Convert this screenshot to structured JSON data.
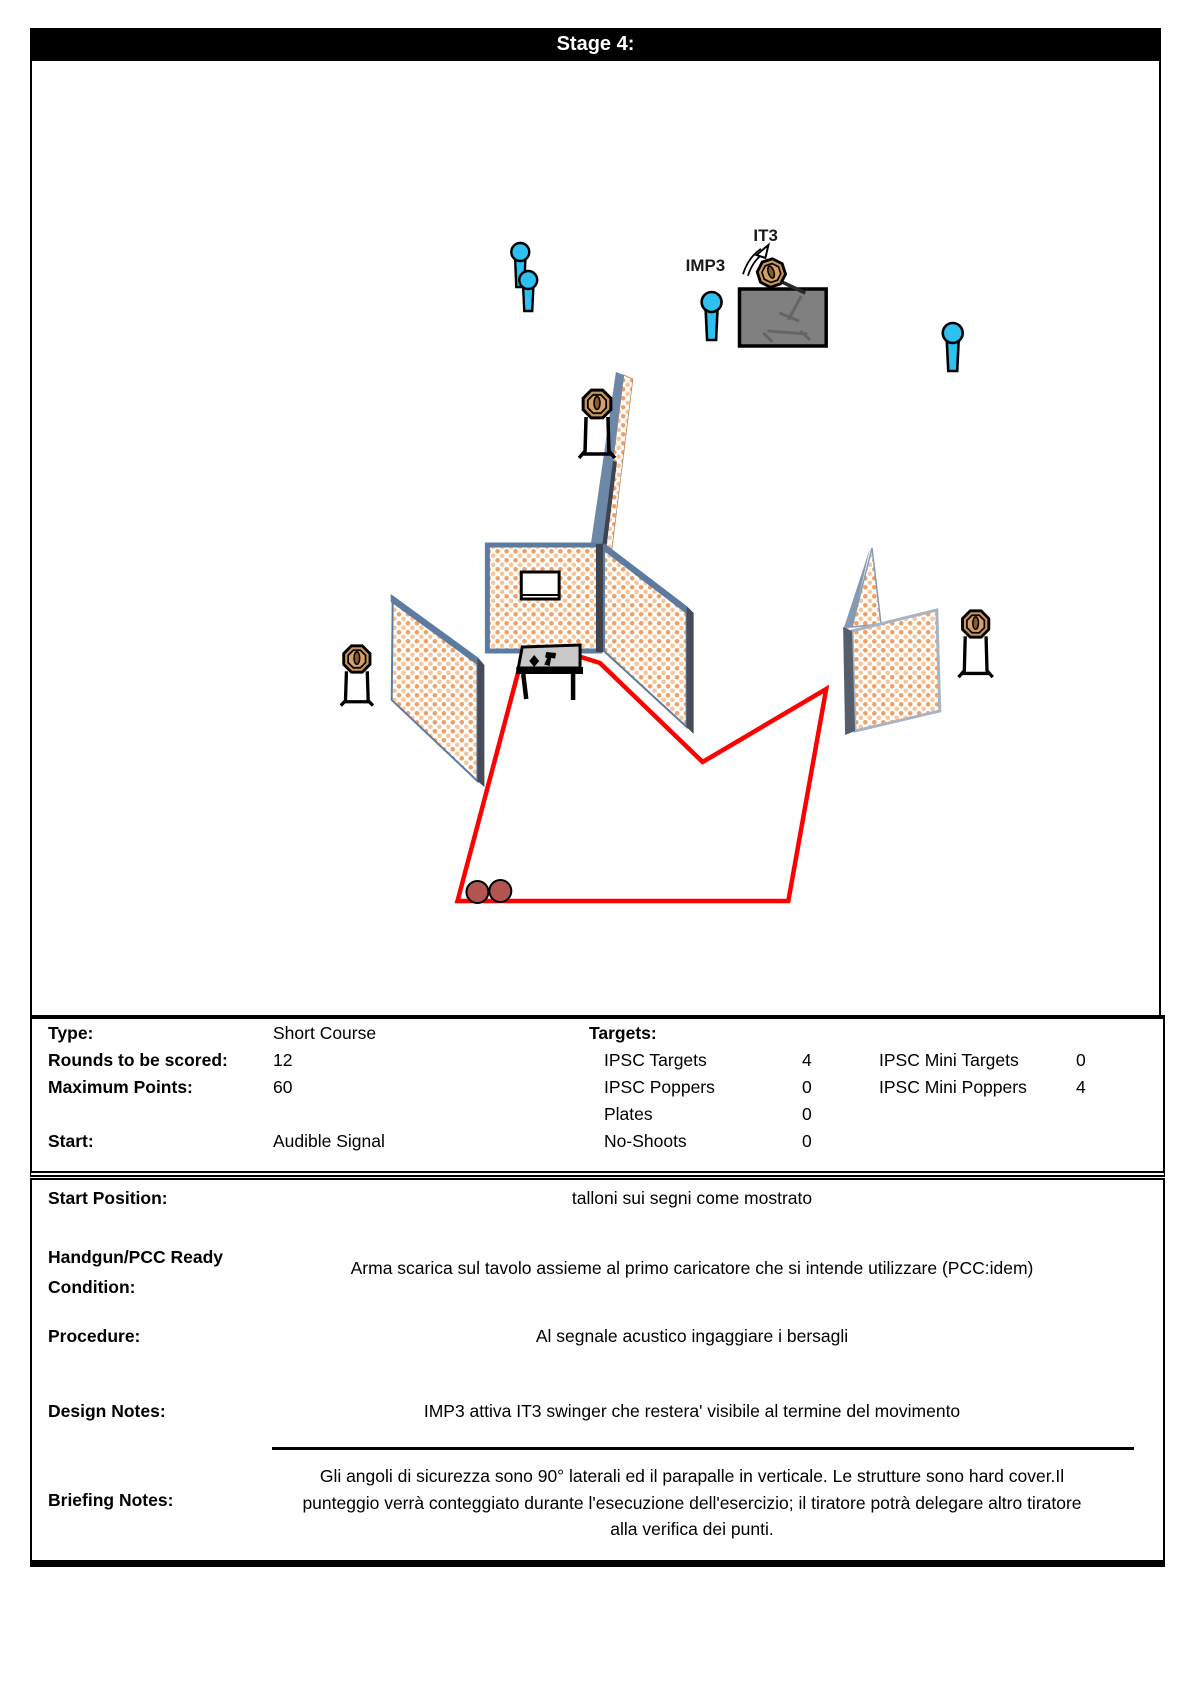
{
  "page": {
    "title": "Stage 4:"
  },
  "diagram": {
    "it3_label": "IT3",
    "imp3_label": "IMP3",
    "colors": {
      "popper": "#2EC1EF",
      "target_face": "#CC9558",
      "course_line": "#FF0000",
      "wall_edge_blue": "#5D7BA0",
      "wall_dark_edge": "#3D434F",
      "swinger_box": "#808080",
      "start_marks": "#B2544F"
    }
  },
  "stats": {
    "type_label": "Type:",
    "type_value": "Short Course",
    "rounds_label": "Rounds to be scored:",
    "rounds_value": "12",
    "max_points_label": "Maximum Points:",
    "max_points_value": "60",
    "start_label": "Start:",
    "start_value": "Audible Signal",
    "targets_header": "Targets:",
    "ipsc_targets_label": "IPSC Targets",
    "ipsc_targets_count": "4",
    "ipsc_poppers_label": "IPSC Poppers",
    "ipsc_poppers_count": "0",
    "plates_label": "Plates",
    "plates_count": "0",
    "no_shoots_label": "No-Shoots",
    "no_shoots_count": "0",
    "ipsc_mini_targets_label": "IPSC Mini Targets",
    "ipsc_mini_targets_count": "0",
    "ipsc_mini_poppers_label": "IPSC Mini Poppers",
    "ipsc_mini_poppers_count": "4"
  },
  "briefing": {
    "start_position_label": "Start Position:",
    "start_position_value": "talloni sui segni come mostrato",
    "ready_condition_label": "Handgun/PCC Ready Condition:",
    "ready_condition_value": "Arma scarica sul tavolo assieme al primo caricatore che si intende utilizzare (PCC:idem)",
    "procedure_label": "Procedure:",
    "procedure_value": "Al segnale acustico ingaggiare i bersagli",
    "design_notes_label": "Design Notes:",
    "design_notes_value": "IMP3 attiva IT3 swinger che restera' visibile al termine del movimento",
    "briefing_notes_label": "Briefing Notes:",
    "briefing_notes_value": "Gli angoli di sicurezza sono 90° laterali ed il parapalle in verticale. Le strutture sono hard cover.Il punteggio verrà conteggiato durante l'esecuzione dell'esercizio; il tiratore potrà delegare altro tiratore alla verifica dei punti."
  }
}
